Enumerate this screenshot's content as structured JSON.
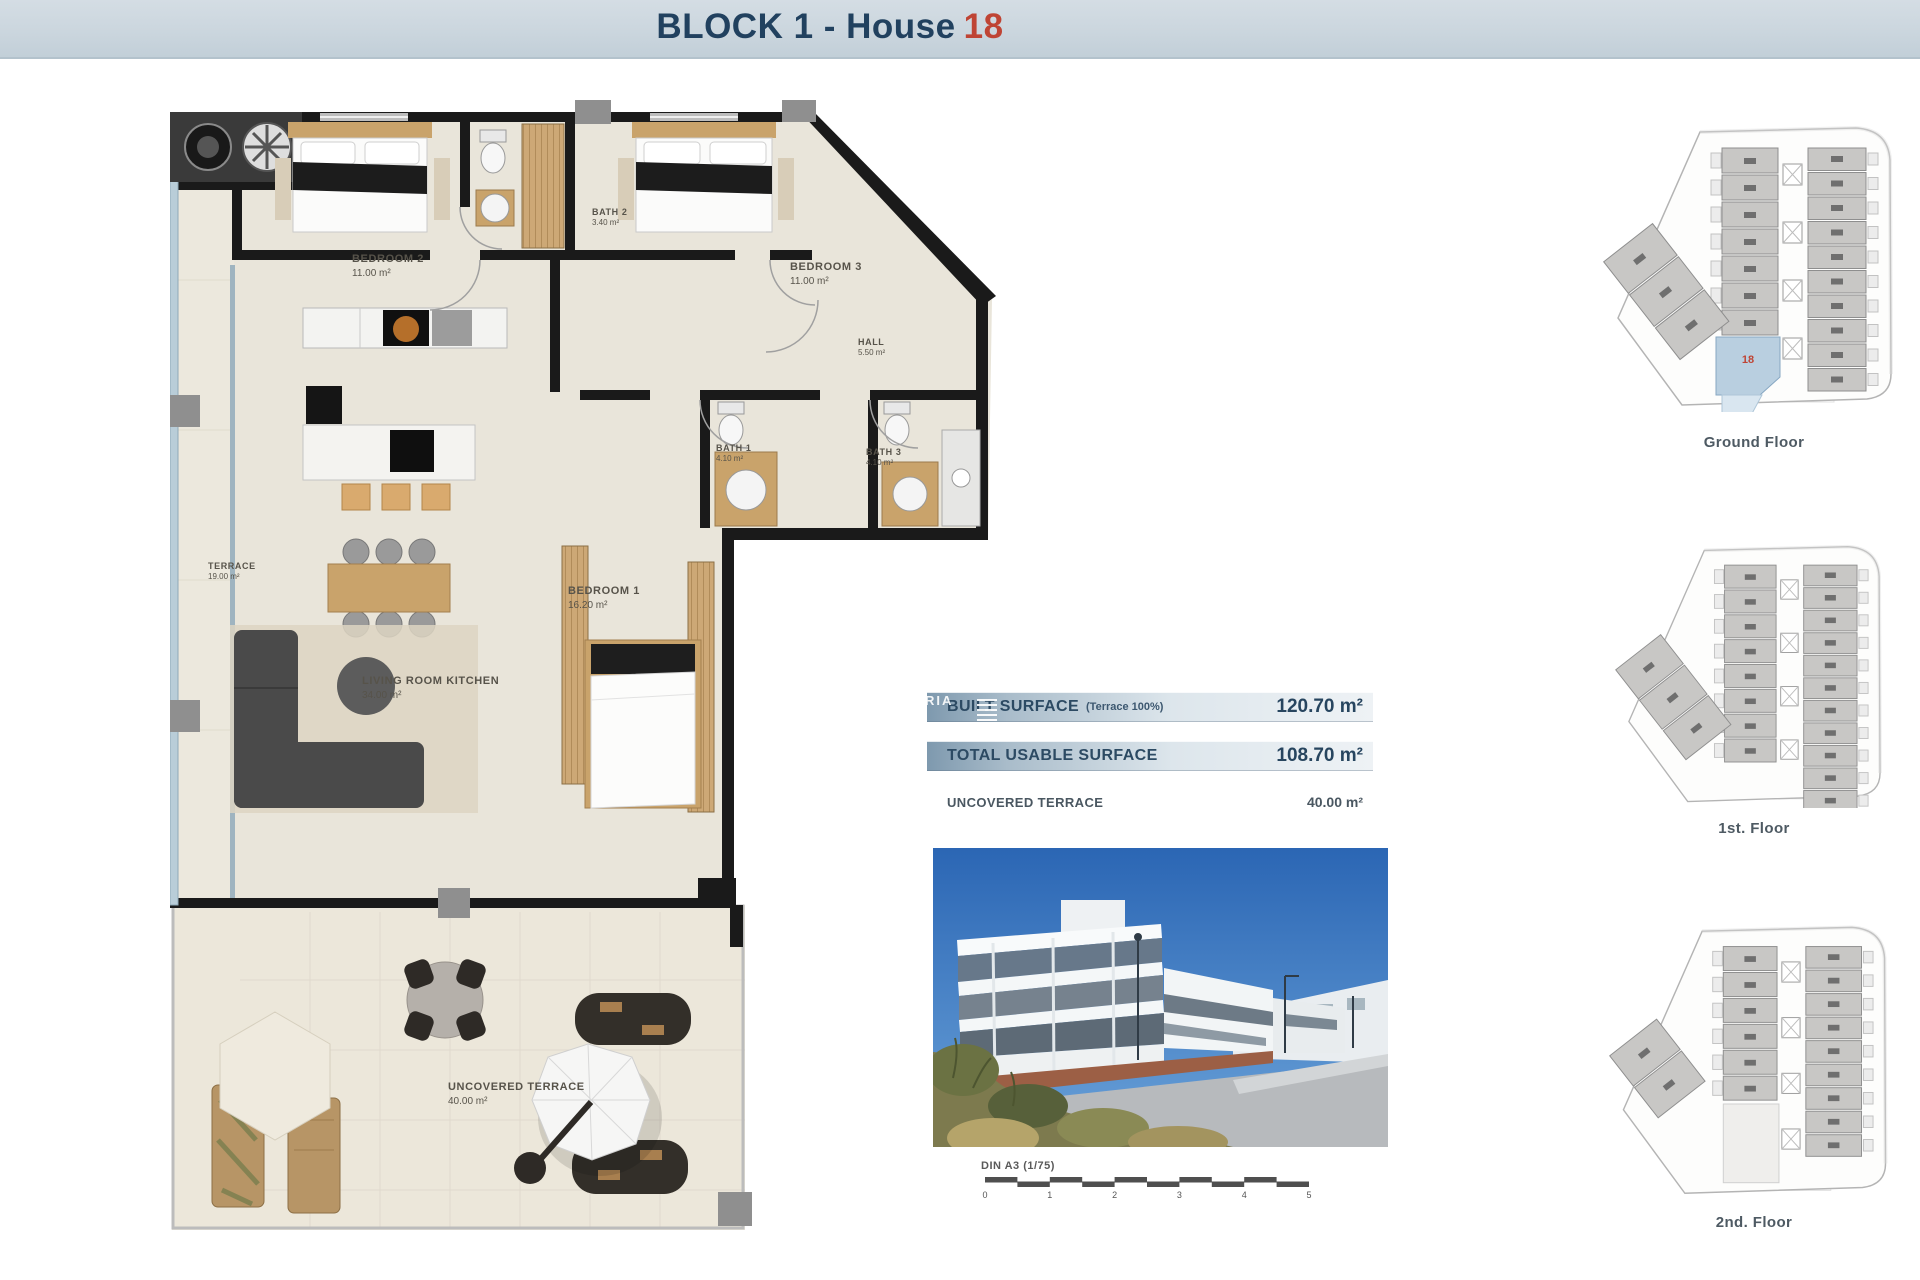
{
  "header": {
    "title_prefix": "BLOCK 1 - House",
    "title_number": "18"
  },
  "watermark": {
    "text": "RIA"
  },
  "floor_plan": {
    "rooms": [
      {
        "name": "BEDROOM 2",
        "area": "11.00 m²"
      },
      {
        "name": "BATH 2",
        "area": "3.40 m²"
      },
      {
        "name": "BEDROOM 3",
        "area": "11.00 m²"
      },
      {
        "name": "HALL",
        "area": "5.50 m²"
      },
      {
        "name": "BATH 1",
        "area": "4.10 m²"
      },
      {
        "name": "BATH 3",
        "area": "4.10 m²"
      },
      {
        "name": "BEDROOM 1",
        "area": "16.20 m²"
      },
      {
        "name": "LIVING ROOM KITCHEN",
        "area": "34.00 m²"
      },
      {
        "name": "TERRACE",
        "area": "19.00 m²"
      },
      {
        "name": "UNCOVERED TERRACE",
        "area": "40.00 m²"
      }
    ]
  },
  "surface_table": {
    "rows": [
      {
        "label": "BUILT SURFACE",
        "note": "(Terrace 100%)",
        "value": "120.70 m²"
      },
      {
        "label": "TOTAL USABLE SURFACE",
        "note": "",
        "value": "108.70 m²"
      },
      {
        "label": "UNCOVERED TERRACE",
        "note": "",
        "value": "40.00 m²"
      }
    ]
  },
  "scale_bar": {
    "label": "DIN A3 (1/75)",
    "ticks": [
      "0",
      "1",
      "2",
      "3",
      "4",
      "5"
    ]
  },
  "site_plans": [
    {
      "label": "Ground Floor",
      "left_units": 7,
      "right_units": 10,
      "diag_units": 3,
      "highlight_unit": "18"
    },
    {
      "label": "1st. Floor",
      "left_units": 8,
      "right_units": 11,
      "diag_units": 3,
      "highlight_unit": null
    },
    {
      "label": "2nd. Floor",
      "left_units": 6,
      "right_units": 9,
      "diag_units": 2,
      "highlight_unit": null
    }
  ],
  "colors": {
    "accent_red": "#bf4434",
    "title_navy": "#21415f",
    "bar_blue": "#7e99ae",
    "highlight_unit_fill": "#b9cfe0",
    "wall_black": "#1a1a1a",
    "wood": "#c9a36b",
    "floor_beige": "#e9e5da"
  }
}
